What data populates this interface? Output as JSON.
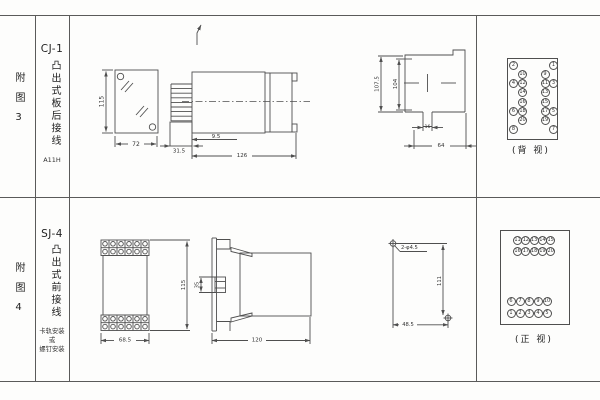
{
  "page": {
    "line_color": "#4f4f4f",
    "background": "#fdfdfc"
  },
  "fig3": {
    "index_label": "附图3",
    "model": "CJ-1",
    "mount_type": "凸出式板后接线",
    "code": "A11H",
    "front_view": {
      "height_dim": "115",
      "width_dim": "72"
    },
    "side_view": {
      "pin_dim": "31.5",
      "offset_dim": "9.5",
      "length_dim": "126"
    },
    "cutout_view": {
      "outer_dim": "107.5",
      "inner_dim": "104",
      "slot_dim": "16",
      "width_dim": "64"
    },
    "rear_view": {
      "caption": "(背 视)",
      "rows": [
        [
          "2",
          "",
          "",
          "1"
        ],
        [
          "",
          "10",
          "9",
          ""
        ],
        [
          "4",
          "12",
          "11",
          "3"
        ],
        [
          "",
          "14",
          "13",
          ""
        ],
        [
          "",
          "16",
          "15",
          ""
        ],
        [
          "6",
          "18",
          "17",
          "5"
        ],
        [
          "",
          "20",
          "19",
          ""
        ],
        [
          "8",
          "",
          "",
          "7"
        ]
      ]
    }
  },
  "fig4": {
    "index_label": "附图4",
    "model": "SJ-4",
    "mount_type": "凸出式前接线",
    "mount_note": [
      "卡轨安装",
      "或",
      "螺钉安装"
    ],
    "front_view": {
      "width_dim": "68.5",
      "height_dim": "115"
    },
    "side_view": {
      "rail_dim": "35",
      "depth_dim": "120"
    },
    "drill_view": {
      "caption": "螺钉安装开孔图",
      "hole_label": "2-φ4.5",
      "v_dim": "111",
      "h_dim": "48.5"
    },
    "front_terminal_view": {
      "caption": "(正 视)",
      "top_rows": [
        [
          "11",
          "12",
          "13",
          "14",
          "15"
        ],
        [
          "16",
          "17",
          "18",
          "19",
          "20"
        ]
      ],
      "bottom_rows": [
        [
          "6",
          "7",
          "8",
          "9",
          "10"
        ],
        [
          "1",
          "2",
          "3",
          "4",
          "5"
        ]
      ]
    }
  }
}
